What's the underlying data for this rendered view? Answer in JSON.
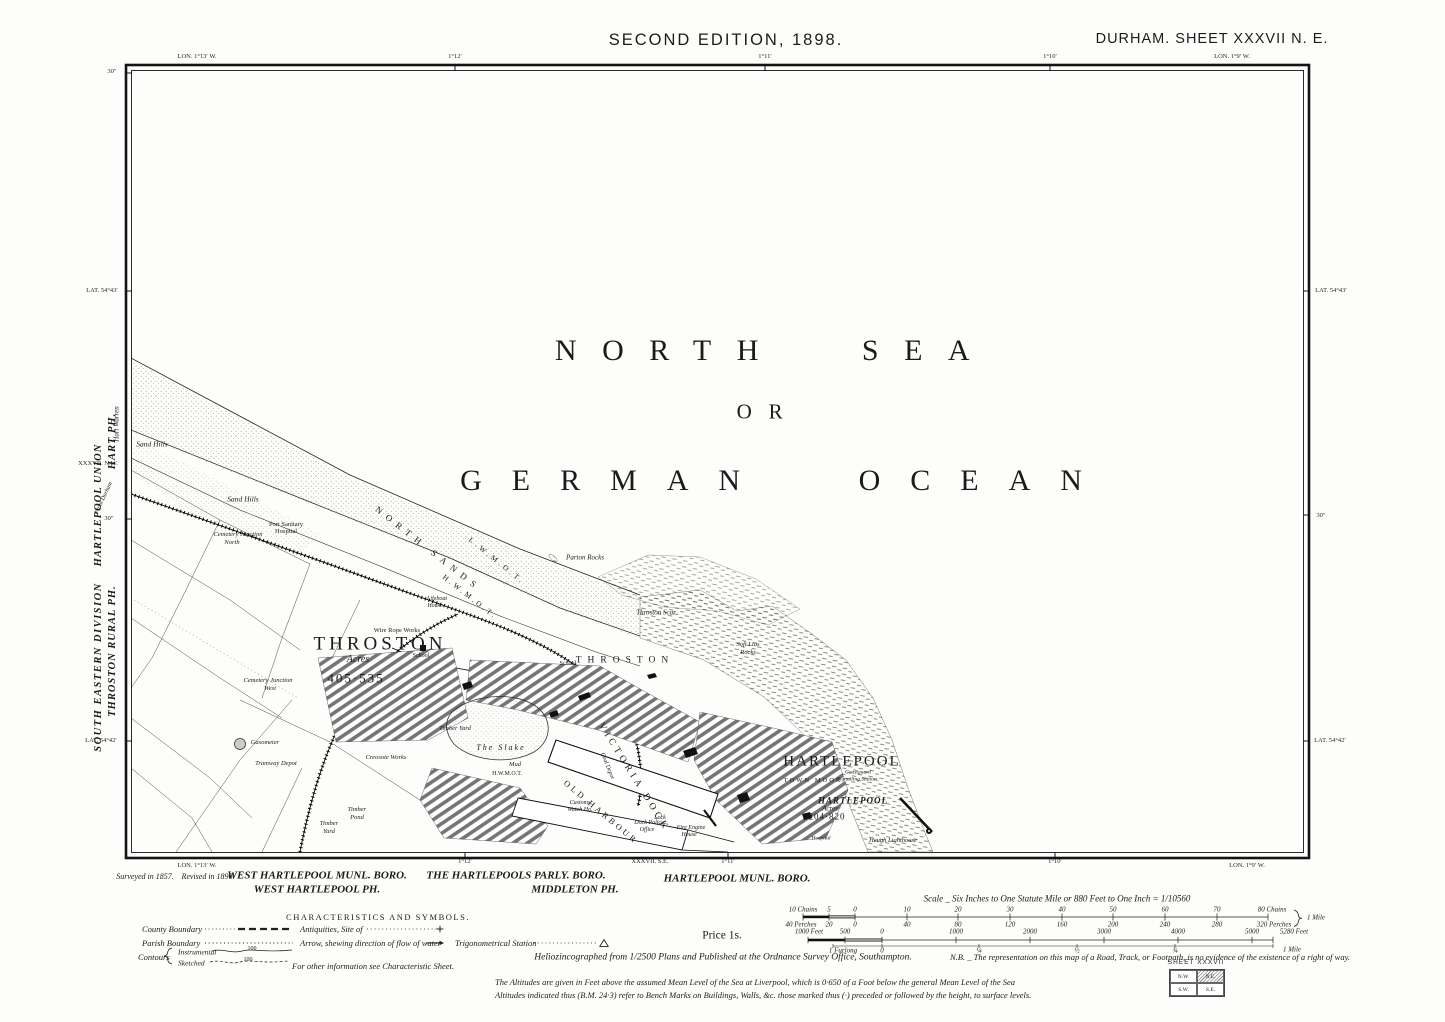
{
  "colors": {
    "ink": "#1b1b1b",
    "paper": "#fdfdfb"
  },
  "header": {
    "edition": "SECOND EDITION, 1898.",
    "sheet_title": "DURHAM.  SHEET  XXXVII  N. E."
  },
  "graticule": {
    "lon_top_left": "LON. 1°13′ W.",
    "lon_top_t1": "1°12′",
    "lon_top_t2": "1°11′",
    "lon_top_t3": "1°10′",
    "lon_top_right": "LON. 1°9′ W.",
    "lon_bot_left": "LON. 1°13′ W.",
    "lon_bot_t1": "1°12′",
    "lon_bot_t2": "1°11′",
    "lon_bot_t3": "1°10′",
    "lon_bot_right": "LON. 1°9′ W.",
    "lat_left_43": "LAT. 54°43′",
    "lat_left_42": "LAT. 54°42′",
    "lat_right_43": "LAT. 54°43′",
    "lat_right_42": "LAT. 54°42′",
    "sec_top_left": "30″",
    "sec_left_mid": "30″",
    "sec_right_mid": "30″",
    "adj_sheet_left": "XXXVII. N.W.",
    "adj_sheet_bottom": "XXXVII. S.E."
  },
  "margin_left": {
    "division": "SOUTH EASTERN DIVISION",
    "rural_parish": "THROSTON RURAL PH.",
    "union": "HARTLEPOOL UNION",
    "hart_parish": "HART PH.",
    "hart_warren": "Hart Warren",
    "from_durham": "From Durham"
  },
  "sea": {
    "name_1": "NORTH SEA",
    "name_2": "OR",
    "name_3": "GERMAN OCEAN",
    "north_sands": "NORTH SANDS",
    "lwmot": "L.W.M.O.T.",
    "hwmot": "H.W.M.O.T.",
    "hwmot_slake": "H.W.M.O.T.",
    "parton_rocks": "Parton Rocks",
    "throston_scar": "Throston Scar",
    "soft_lias_1": "Soft Lias",
    "soft_lias_2": "Rocks"
  },
  "map": {
    "sand_hills_1": "Sand Hills",
    "sand_hills_2": "Sand Hills",
    "port_sanitary_1": "Port Sanitary",
    "port_sanitary_2": "Hospital",
    "cemetery_north_1": "Cemetery Junction",
    "cemetery_north_2": "North",
    "cemetery_west_1": "Cemetery Junction",
    "cemetery_west_2": "West",
    "wire_rope_works": "Wire Rope Works",
    "school_1": "School",
    "school_2": "School",
    "throston": "THROSTON",
    "throston_acres_label": "Acres",
    "throston_acres": "405·535",
    "throston_spread": "THROSTON",
    "gasometer": "Gasometer",
    "tramway_depot": "Tramway Depot",
    "creosote_works": "Creosote Works",
    "timber_pond_1": "Timber",
    "timber_pond_2": "Pond",
    "timber_yard": "Timber Yard",
    "timber_yard_1": "Timber",
    "timber_yard_2": "Yard",
    "the_slake": "The Slake",
    "mud": "Mud",
    "victoria_dock": "VICTORIA DOCK",
    "old_harbour": "OLD HARBOUR",
    "coal_depot": "Coal Depot",
    "customs_1": "Customs",
    "customs_2": "Watch Ho.",
    "dock_police_1": "Dock Police",
    "dock_police_2": "Office",
    "fire_engine_1": "Fire Engine",
    "fire_engine_2": "House",
    "lock": "Lock",
    "lifeboat_1": "Lifeboat",
    "lifeboat_2": "House",
    "hartlepool": "HARTLEPOOL",
    "coastguard_1": "Coastguard",
    "coastguard_2": "Signalling Station",
    "town_moor": "TOWN MOOR",
    "hartlepool_small": "HARTLEPOOL",
    "hartlepool_acres_label": "Acres",
    "hartlepool_acres": "204·820",
    "hospital": "Hospital",
    "heugh_lighthouse": "Heugh Lighthouse"
  },
  "footer": {
    "surveyed": "Surveyed in 1857.",
    "revised": "Revised in 1896.",
    "boro_w1": "WEST HARTLEPOOL MUNL. BORO.",
    "boro_w2": "WEST HARTLEPOOL PH.",
    "boro_p1": "THE HARTLEPOOLS PARLY. BORO.",
    "boro_p2": "MIDDLETON PH.",
    "boro_h": "HARTLEPOOL MUNL. BORO.",
    "price": "Price 1s.",
    "imprint": "Heliozincographed from 1/2500 Plans and Published at the Ordnance Survey Office, Southampton.",
    "nb": "N.B. _ The representation on this map of a Road, Track, or Footpath, is no evidence of the existence of a right of way.",
    "note1": "The Altitudes are given in Feet above the assumed Mean Level of the Sea at Liverpool, which is 0·650 of a Foot below the general Mean Level of the Sea",
    "note2": "Altitudes indicated thus (B.M. 24·3) refer to Bench Marks on Buildings, Walls, &c. those marked thus (·) preceded or followed by the height, to surface levels."
  },
  "legend": {
    "title": "CHARACTERISTICS AND SYMBOLS.",
    "county": "County Boundary",
    "parish": "Parish Boundary",
    "contours": "Contours",
    "instrumental": "Instrumental",
    "sketched": "Sketched",
    "contour_value": "100",
    "antiquities": "Antiquities, Site of",
    "arrow": "Arrow, shewing direction of flow of water",
    "trig": "Trigonometrical Station",
    "other_info": "For other information see Characteristic Sheet."
  },
  "scale": {
    "title": "Scale _ Six Inches to One Statute Mile or 880 Feet to One Inch = 1/10560",
    "chains": [
      "10 Chains",
      "5",
      "0",
      "10",
      "20",
      "30",
      "40",
      "50",
      "60",
      "70",
      "80 Chains"
    ],
    "perches": [
      "40 Perches",
      "20",
      "0",
      "40",
      "80",
      "120",
      "160",
      "200",
      "240",
      "280",
      "320 Perches"
    ],
    "feet": [
      "1000 Feet",
      "500",
      "0",
      "1000",
      "2000",
      "3000",
      "4000",
      "5000",
      "5280 Feet"
    ],
    "furlongs": [
      "1 Furlong",
      "0",
      "¼",
      "½",
      "¾"
    ],
    "mile_1": "1 Mile",
    "mile_2": "1 Mile"
  },
  "sheet_index": {
    "title": "SHEET XXXVII",
    "nw": "N.W.",
    "ne": "N.E.",
    "sw": "S.W.",
    "se": "S.E."
  }
}
